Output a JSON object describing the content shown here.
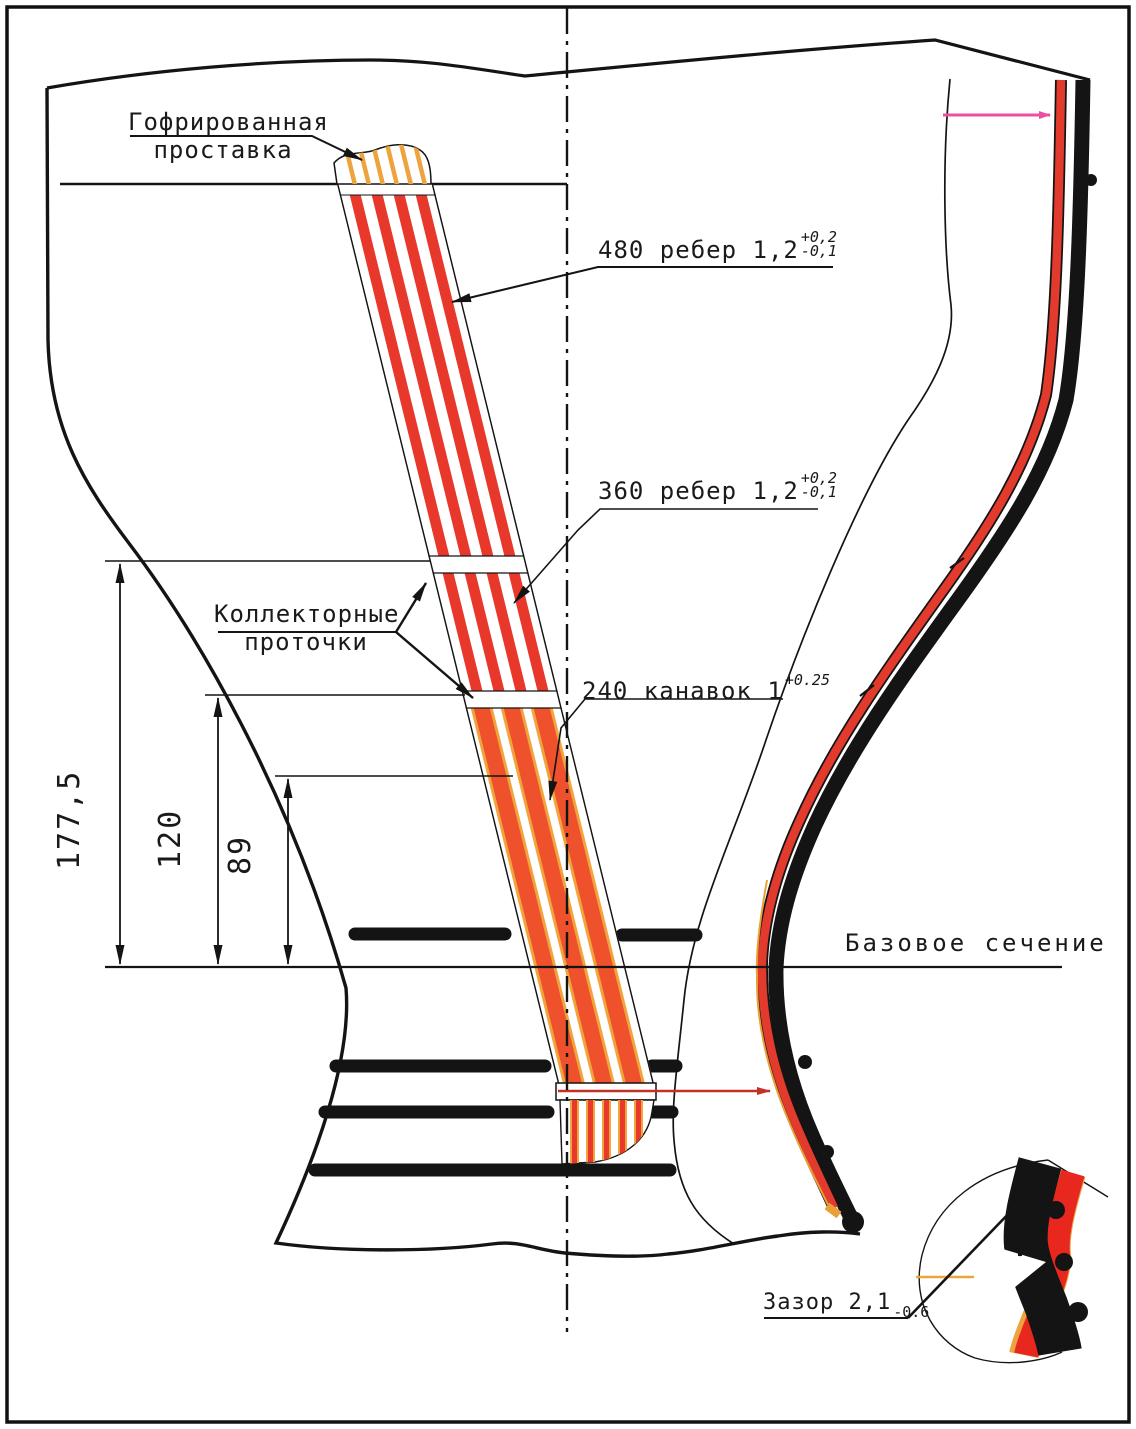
{
  "drawing": {
    "labels": {
      "corrugated_spacer": {
        "line1": "Гофрированная",
        "line2": "проставка"
      },
      "ribs_480": {
        "text": "480  ребер 1,2",
        "tol_plus": "+0,2",
        "tol_minus": "-0,1"
      },
      "ribs_360": {
        "text": "360 ребер 1,2",
        "tol_plus": "+0,2",
        "tol_minus": "-0,1"
      },
      "collector_grooves": {
        "line1": "Коллекторные",
        "line2": "проточки"
      },
      "grooves_240": {
        "text": "240 канавок 1",
        "tol": "+0.25"
      },
      "base_section": "Базовое сечение",
      "gap": {
        "text": "Зазор 2,1",
        "tol": "-0.6"
      }
    },
    "dimensions": {
      "height_total": "177,5",
      "height_mid": "120",
      "height_small": "89"
    },
    "colors": {
      "stripe_red": "#e8372b",
      "stripe_orange_core": "#ee512b",
      "stripe_yellow_edge": "#f2a43c",
      "cap_orange": "#eda43e",
      "wall_red": "#e23a2c",
      "wall_orange_edge": "#e8a037",
      "pink": "#ec4fa0",
      "detail_red": "#e8281e",
      "line_red": "#c23028",
      "ink": "#141414"
    }
  }
}
